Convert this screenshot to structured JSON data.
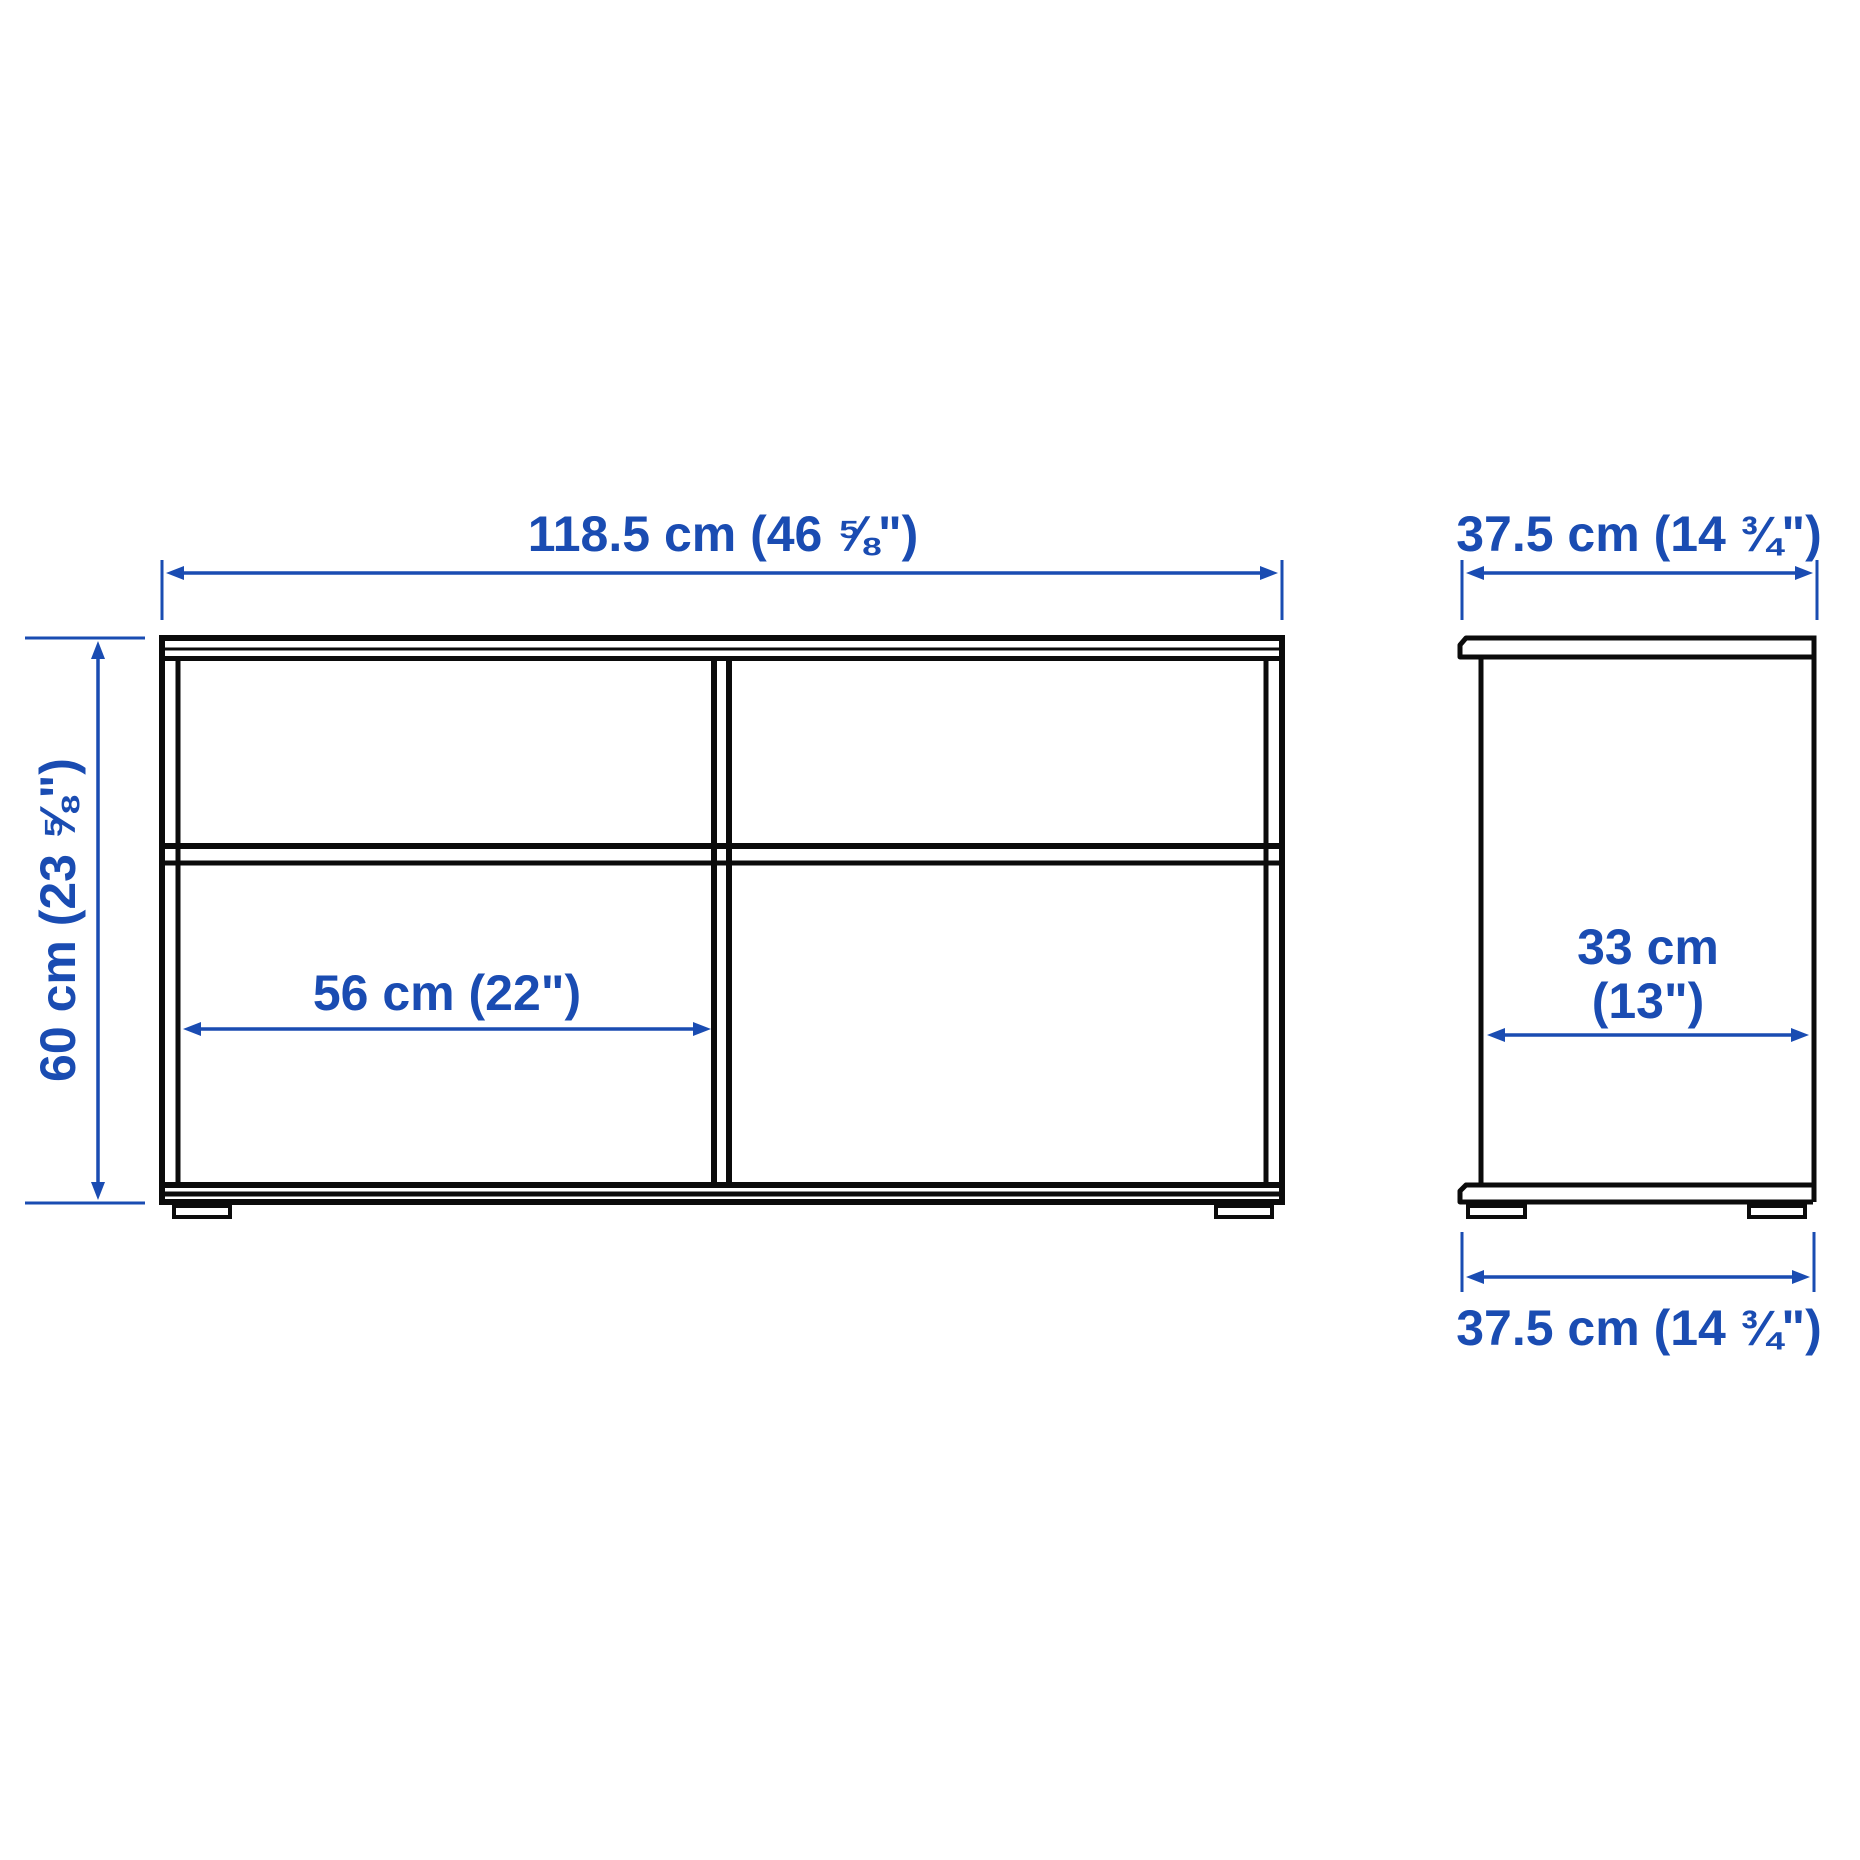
{
  "diagram": {
    "type": "furniture-dimension-drawing",
    "views": {
      "front": {
        "width_label": "118.5 cm (46 ⅝\")",
        "height_label": "60 cm (23 ⅝\")",
        "compartment_width_label": "56 cm (22\")"
      },
      "side": {
        "top_width_label": "37.5 cm (14 ¾\")",
        "bottom_width_label": "37.5 cm (14 ¾\")",
        "inner_depth_label_line1": "33 cm",
        "inner_depth_label_line2": "(13\")"
      }
    },
    "colors": {
      "dimension_blue": "#1a4cb2",
      "line_black": "#0b0b0b",
      "background": "#ffffff"
    }
  }
}
